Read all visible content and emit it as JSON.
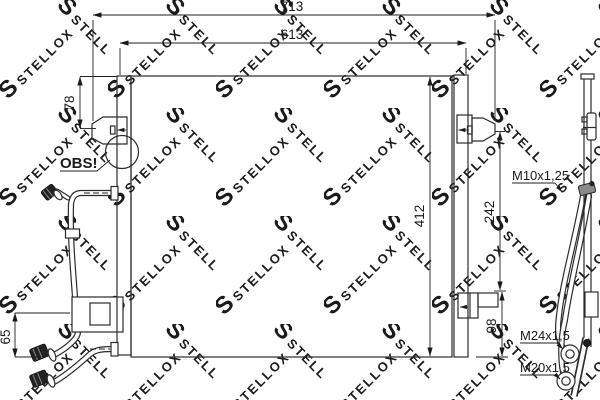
{
  "watermark": {
    "brand": "STELLOX",
    "logo_letter": "S"
  },
  "dimensions": {
    "total_width": "713",
    "core_width": "613",
    "bracket_top_offset": "78",
    "core_height": "412",
    "right_bracket_spacing": "242",
    "bottom_bracket_offset": "98",
    "pipe_bottom_offset": "65"
  },
  "callouts": {
    "obs": "OBS!",
    "thread_m10": "M10x1,25",
    "thread_m24": "M24x1,5",
    "thread_m20": "M20x1,5"
  }
}
